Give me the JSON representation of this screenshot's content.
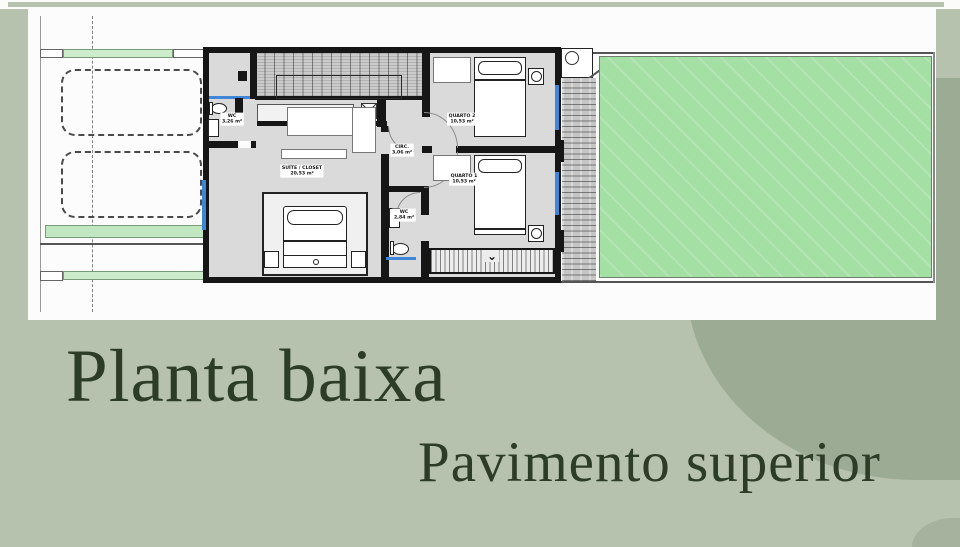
{
  "titles": {
    "main": "Planta baixa",
    "sub": "Pavimento superior"
  },
  "plan": {
    "rooms": {
      "wc1": {
        "name": "WC",
        "area": "3,26 m²"
      },
      "suite": {
        "name": "SUÍTE / CLOSET",
        "area": "20,53 m²"
      },
      "circ": {
        "name": "CIRC.",
        "area": "3,06 m²"
      },
      "quarto2": {
        "name": "QUARTO 2",
        "area": "10,53 m²"
      },
      "quarto1": {
        "name": "QUARTO 1",
        "area": "10,53 m²"
      },
      "wc2": {
        "name": "WC",
        "area": "2,84 m²"
      }
    }
  },
  "icons": {
    "stair_direction_chevron": "⌄"
  },
  "colors": {
    "sage_background": "#b6c2ad",
    "accent_blob": "#9cab93",
    "lawn_green": "#a4dfa3",
    "planter_green": "#cdeccb",
    "floor_gray": "#dadada",
    "wall_black": "#161616",
    "window_blue": "#3f86d8",
    "title_text": "#2d3c27"
  }
}
